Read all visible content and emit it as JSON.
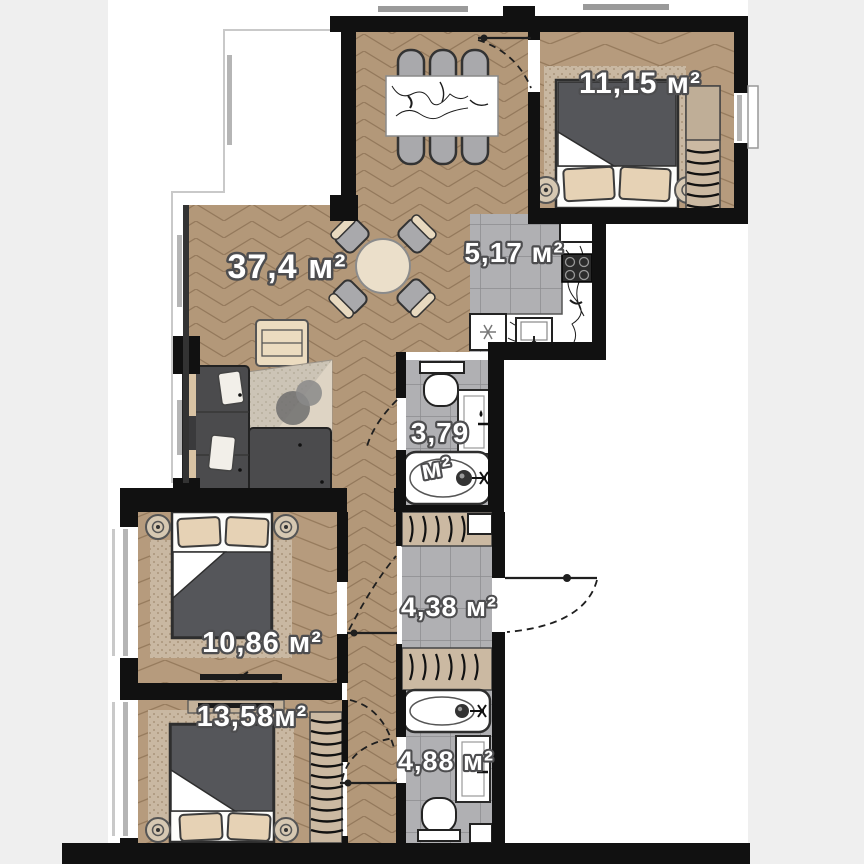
{
  "plan": {
    "type": "apartment-floor-plan",
    "units": "м²",
    "rooms": {
      "living": {
        "name": "living-dining-room",
        "area": "37,4 м²"
      },
      "bedroom_top": {
        "name": "bedroom-top-right",
        "area": "11,15 м²"
      },
      "kitchen": {
        "name": "kitchen",
        "area": "5,17 м²"
      },
      "bathroom_small": {
        "name": "bathroom-small",
        "area_line1": "3,79",
        "area_line2": "м²"
      },
      "hallway": {
        "name": "hallway-wardrobe",
        "area": "4,38 м²"
      },
      "bedroom_left": {
        "name": "bedroom-left",
        "area": "10,86 м²"
      },
      "bedroom_bottom": {
        "name": "bedroom-bottom",
        "area": "13,58м²"
      },
      "bathroom_big": {
        "name": "bathroom-big",
        "area": "4,88 м²"
      }
    },
    "colors": {
      "background": "#efefef",
      "paper": "#ffffff",
      "wall": "#111111",
      "wood_floor": "#b39879",
      "wood_line": "#94795c",
      "tile_floor": "#b0b0b3",
      "tile_line": "#8c8c8f",
      "rug_tan": "#c9b8a2",
      "rug_gray": "#ccc4b6",
      "furniture_dark": "#4b4b4d",
      "pillow_tan": "#e6d2b5",
      "label_fill": "#ffffff",
      "label_stroke": "#4d4d4f"
    }
  }
}
